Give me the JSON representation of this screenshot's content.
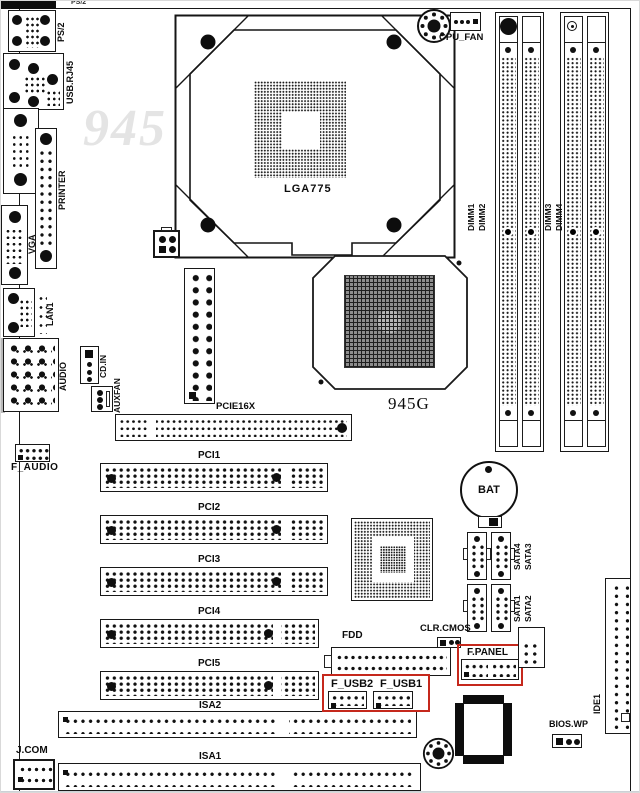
{
  "title": "Motherboard layout diagram",
  "watermark": "945",
  "colors": {
    "highlight_red": "#c5281c",
    "line": "#181818",
    "watermark_gray": "#e4e4e4"
  },
  "rear_io": {
    "ps2_edge": "PS/2",
    "ps2": "PS/2",
    "usb_rj45": "USB.RJ45",
    "com1": "COM1",
    "printer": "PRINTER",
    "vga": "VGA",
    "lan1": "LAN1",
    "audio": "AUDIO"
  },
  "cpu": {
    "socket": "LGA775",
    "fan": "CPU_FAN"
  },
  "chipset": {
    "northbridge": "945G"
  },
  "memory": [
    "DIMM1",
    "DIMM2",
    "DIMM3",
    "DIMM4"
  ],
  "slots": {
    "pcie": "PCIE16X",
    "pci": [
      "PCI1",
      "PCI2",
      "PCI3",
      "PCI4",
      "PCI5"
    ],
    "isa2": "ISA2",
    "isa1": "ISA1"
  },
  "storage": {
    "fdd": "FDD",
    "ide1": "IDE1",
    "sata_top": [
      "SATA4",
      "SATA3"
    ],
    "sata_bottom": [
      "SATA1",
      "SATA2"
    ]
  },
  "headers": {
    "cd_in": "CD.IN",
    "auxfan": "AUXFAN",
    "f_audio": "F_AUDIO",
    "f_panel": "F.PANEL",
    "f_usb2": "F_USB2",
    "f_usb1": "F_USB1",
    "clr_cmos": "CLR.CMOS",
    "bios_wp": "BIOS.WP",
    "j_com": "J.COM",
    "bat": "BAT"
  }
}
